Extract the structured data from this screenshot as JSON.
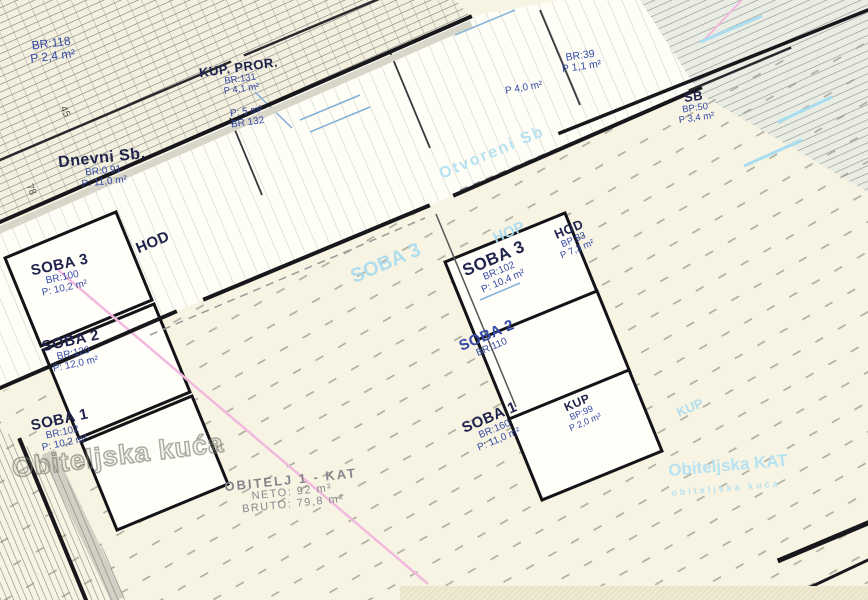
{
  "colors": {
    "paper": "#f7f4e3",
    "wall": "#17171c",
    "blue_text": "#3449a6",
    "dark_text": "#20244d",
    "watermark_blue": "#aadcee",
    "pink_line": "#f2b9de",
    "gray_text": "#85858c"
  },
  "rooms": [
    {
      "name": "",
      "br": "BR:118",
      "area": "P 2,4 m²"
    },
    {
      "name": "KUP. PROR.",
      "br": "BR:131",
      "area": "P 4,1 m²"
    },
    {
      "name": "",
      "br": "BR 132",
      "area": "P: 5 m²"
    },
    {
      "name": "Dnevni Sb.",
      "br": "BR:0.91",
      "area": "P: 11,0 m²"
    },
    {
      "name": "",
      "br": "BR:39",
      "area": "P 1,1 m²"
    },
    {
      "name": "",
      "br": "",
      "area": "P 4,0 m²"
    },
    {
      "name": "SB",
      "br": "BP:50",
      "area": "P 3,4 m²"
    },
    {
      "name": "HOD",
      "br": "",
      "area": ""
    },
    {
      "name": "SOBA 3",
      "br": "BR:102",
      "area": "P: 10,4 m²"
    },
    {
      "name": "HOD",
      "br": "BP:83",
      "area": "P 7,3 m²"
    },
    {
      "name": "SOBA 3",
      "br": "BR:100",
      "area": "P: 10,2 m²"
    },
    {
      "name": "SOBA 2",
      "br": "BR:120",
      "area": "P: 12,0 m²"
    },
    {
      "name": "SOBA 1",
      "br": "BR:102",
      "area": "P: 10,2 m²"
    },
    {
      "name": "SOBA 2",
      "br": "BR:110",
      "area": ""
    },
    {
      "name": "SOBA 1",
      "br": "BR:160",
      "area": "P: 11,0 m²"
    },
    {
      "name": "KUP",
      "br": "BP:99",
      "area": "P 2,0 m²"
    }
  ],
  "watermarks": {
    "big": "Obiteljska kuća",
    "right_line1": "Obiteljska KAT",
    "right_line2": "obiteljska kuća",
    "soba3": "SOBA 3",
    "hop": "HOP",
    "kup": "KUP",
    "otvoreni": "Otvoreni Sb"
  },
  "title_block": {
    "line1": "OBITELJ 1 - KAT",
    "line2": "NETO: 92 m²",
    "line3": "BRUTO: 79,8 m²"
  },
  "dims": {
    "d1": "78",
    "d2": "45"
  }
}
